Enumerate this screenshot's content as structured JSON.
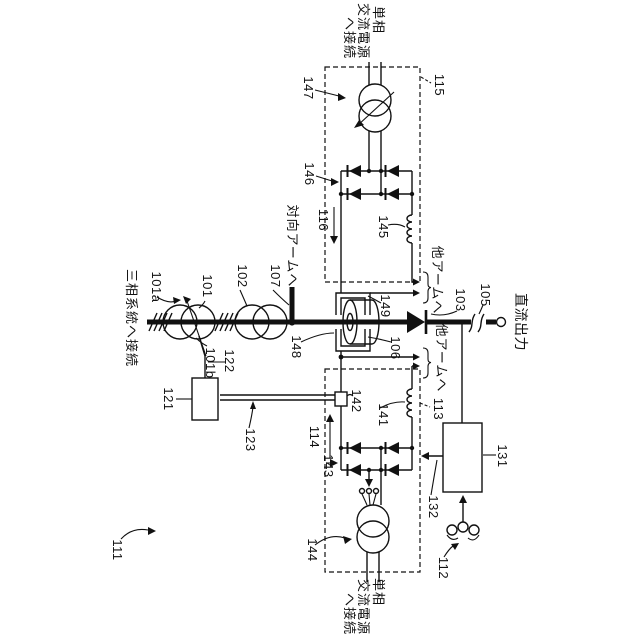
{
  "figure": {
    "type": "patent-circuit-diagram",
    "labels": {
      "three_phase_connect": "三相系統へ接続",
      "single_phase_l1": "単相",
      "single_phase_l2": "交流電源",
      "single_phase_l3": "へ接続",
      "dc_output": "直流出力",
      "opposite_arm": "対向アームへ",
      "other_arm": "他アームへ"
    },
    "refs": {
      "n101": "101",
      "n101a": "101a",
      "n101b": "101b",
      "n102": "102",
      "n103": "103",
      "n105": "105",
      "n106": "106",
      "n107": "107",
      "n111": "111",
      "n112": "112",
      "n113": "113",
      "n114": "114",
      "n115": "115",
      "n116": "116",
      "n121": "121",
      "n122": "122",
      "n123": "123",
      "n131": "131",
      "n132": "132",
      "n141": "141",
      "n142": "142",
      "n143": "143",
      "n144": "144",
      "n145": "145",
      "n146": "146",
      "n147": "147",
      "n148": "148",
      "n149": "149"
    }
  }
}
